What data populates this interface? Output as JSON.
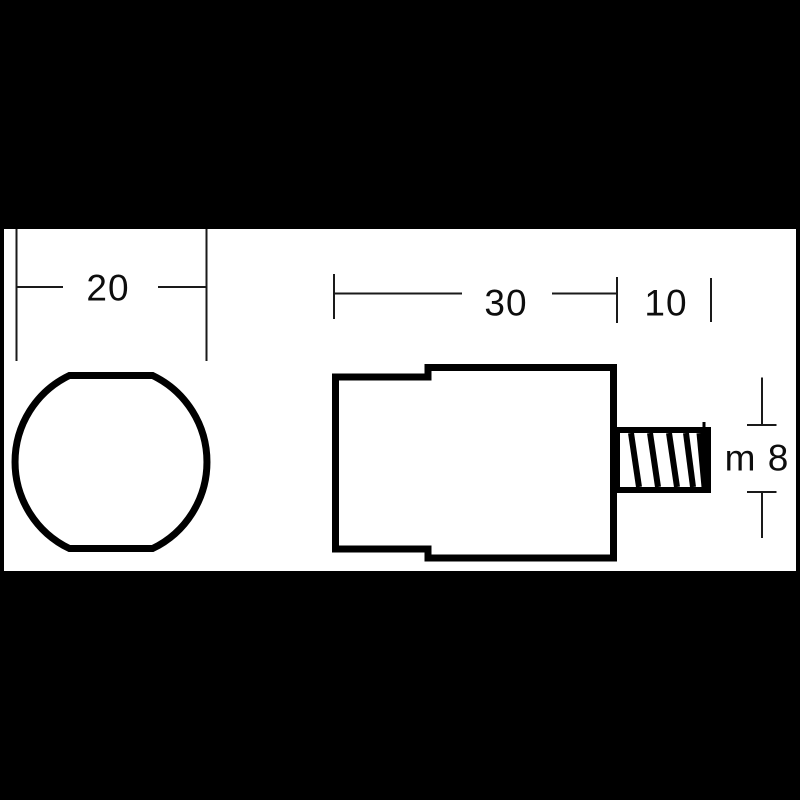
{
  "canvas": {
    "background_color": "#000000",
    "paper_color": "#ffffff",
    "ink_color": "#000000",
    "dimension_line_color": "#1a1a1a"
  },
  "front_view": {
    "diameter_label": "20"
  },
  "side_view": {
    "body_length_label": "30",
    "stud_length_label": "10",
    "thread_label": "m 8"
  }
}
